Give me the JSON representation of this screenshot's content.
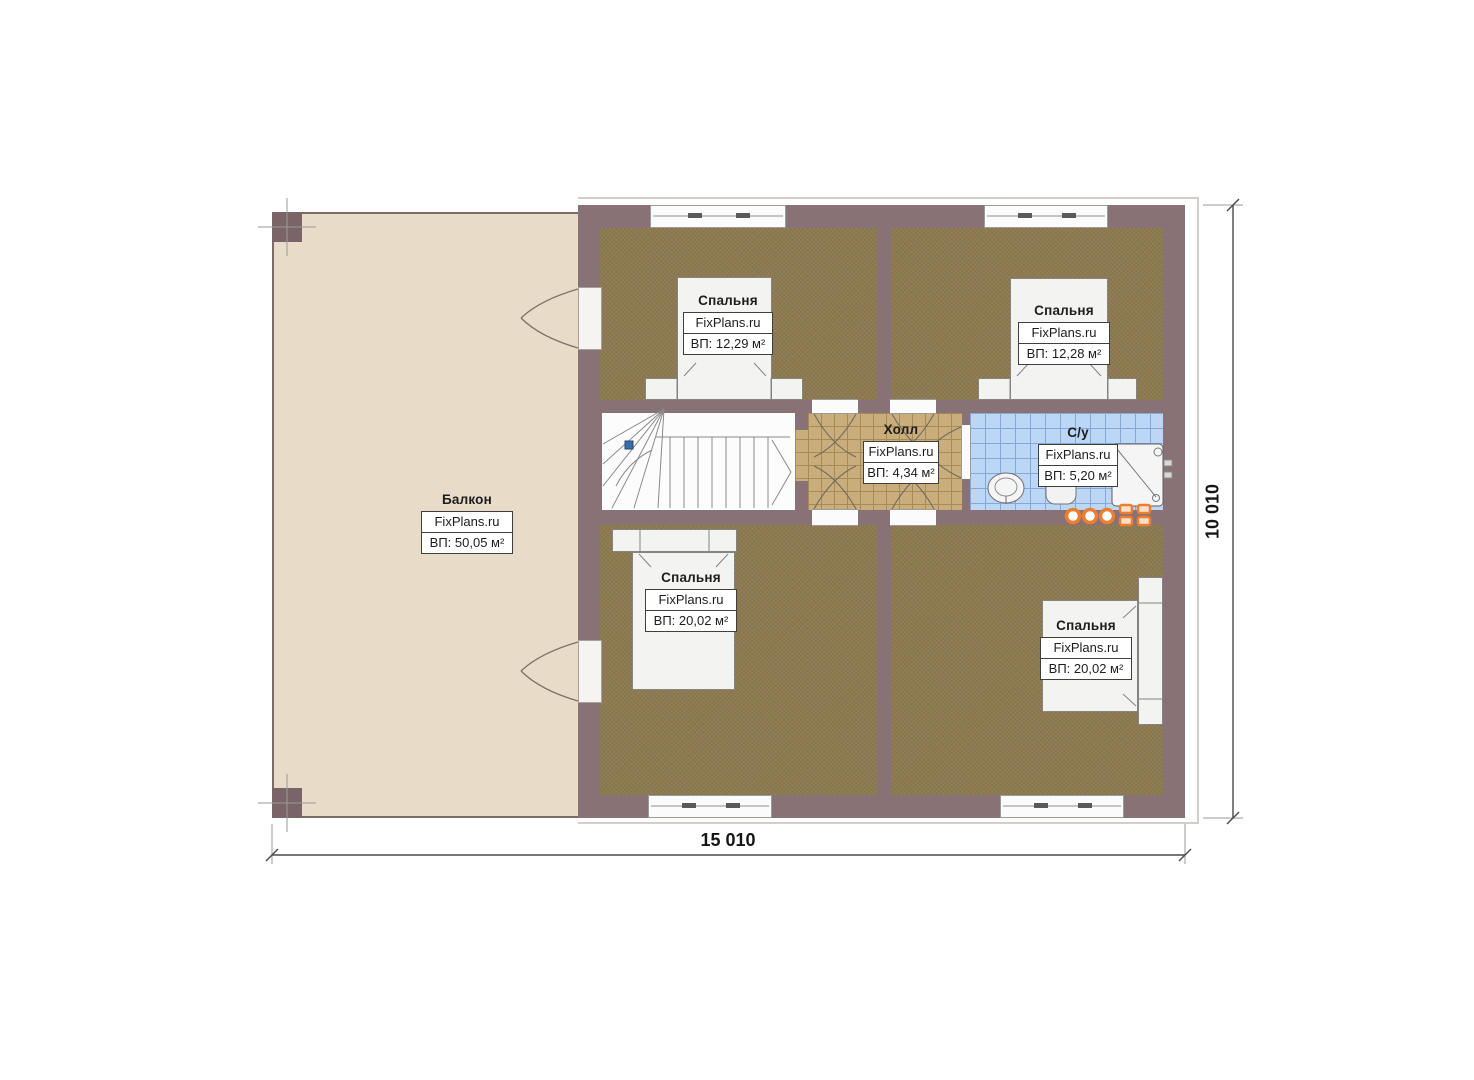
{
  "rooms": [
    {
      "id": "balcony",
      "name": "Балкон",
      "brand": "FixPlans.ru",
      "area": "ВП: 50,05 м²"
    },
    {
      "id": "bedroom-top-left",
      "name": "Спальня",
      "brand": "FixPlans.ru",
      "area": "ВП: 12,29 м²"
    },
    {
      "id": "bedroom-top-right",
      "name": "Спальня",
      "brand": "FixPlans.ru",
      "area": "ВП: 12,28 м²"
    },
    {
      "id": "hall",
      "name": "Холл",
      "brand": "FixPlans.ru",
      "area": "ВП: 4,34 м²"
    },
    {
      "id": "bathroom",
      "name": "С/у",
      "brand": "FixPlans.ru",
      "area": "ВП: 5,20 м²"
    },
    {
      "id": "bedroom-bottom-left",
      "name": "Спальня",
      "brand": "FixPlans.ru",
      "area": "ВП: 20,02 м²"
    },
    {
      "id": "bedroom-bottom-right",
      "name": "Спальня",
      "brand": "FixPlans.ru",
      "area": "ВП: 20,02 м²"
    }
  ],
  "dimensions": {
    "width": "15 010",
    "height": "10 010"
  },
  "colors": {
    "wall": "#887275",
    "balcony_floor": "#e8dbc8",
    "bedroom_floor": "#8e7a51",
    "hall_floor": "#c9ad7b",
    "bathroom_floor": "#bcd6f5",
    "accent_orange": "#ed7d31",
    "stair_marker_blue": "#3a6ca6"
  }
}
